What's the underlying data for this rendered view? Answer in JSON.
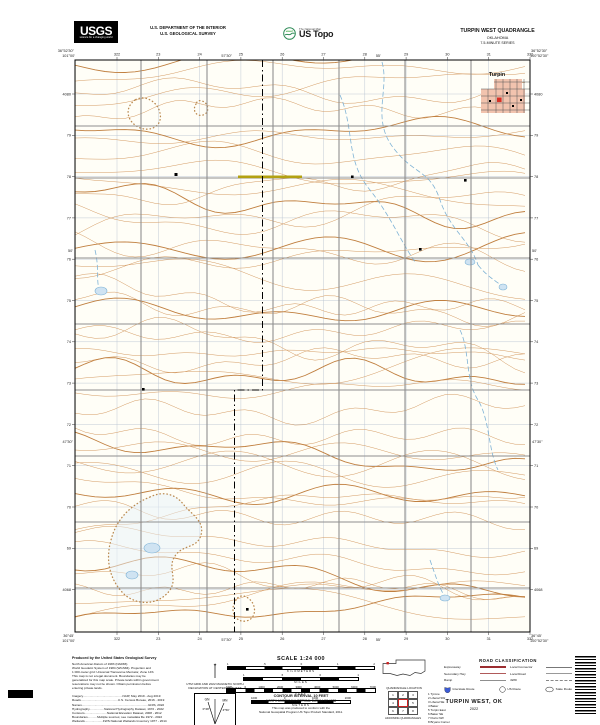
{
  "header": {
    "usgs_logo": "USGS",
    "usgs_tagline": "science for a changing world",
    "dept_line1": "U.S. DEPARTMENT OF THE INTERIOR",
    "dept_line2": "U.S. GEOLOGICAL SURVEY",
    "ustopo_super": "The National Map",
    "ustopo_brand": "US Topo",
    "quad_title": "TURPIN WEST QUADRANGLE",
    "state": "OKLAHOMA",
    "series": "7.5-MINUTE SERIES"
  },
  "map": {
    "town_label": "Turpin",
    "corners": {
      "top_left_lon": "101°00'",
      "top_left_lat": "36°52'30\"",
      "top_right_lon": "100°52'30\"",
      "top_right_lat": "36°52'30\"",
      "bottom_left_lon": "101°00'",
      "bottom_left_lat": "36°45'",
      "bottom_right_lon": "100°52'30\"",
      "bottom_right_lat": "36°45'"
    },
    "edge_ticks": {
      "top": [
        "57'30\"",
        "55'"
      ],
      "bottom": [
        "57'30\"",
        "55'"
      ],
      "left": [
        "50'",
        "47'30\""
      ],
      "right": [
        "50'",
        "47'30\""
      ]
    },
    "eastings": [
      "322",
      "23",
      "24",
      "25",
      "26",
      "27",
      "28",
      "29",
      "30",
      "31",
      "332"
    ],
    "northings": [
      "4080",
      "79",
      "78",
      "77",
      "76",
      "75",
      "74",
      "73",
      "72",
      "71",
      "70",
      "69",
      "4068"
    ]
  },
  "footer": {
    "credits": [
      "Produced by the United States Geological Survey",
      "North American Datum of 1983 (NAD83)",
      "World Geodetic System of 1984 (WGS84). Projection and",
      "1 000-meter grid: Universal Transverse Mercator, Zone 14S",
      "This map is not a legal document. Boundaries may be",
      "generalized for this map scale. Private lands within government",
      "reservations may not be shown. Obtain permission before",
      "entering private lands.",
      "",
      "Imagery..............................................NAIP, May 2019 - Aug 2019",
      "Roads...........................................U.S. Census Bureau, 2016 - 2019",
      "Names.............................................................................GNIS, 2022",
      "Hydrography.................National Hydrography Dataset, 1972 - 2022",
      "Contours..........................National Elevation Dataset, 2008 - 2012",
      "Boundaries...........Multiple sources; see metadata file 1972 - 2022",
      "Wetlands.....................FWS National Wetlands Inventory 1977 - 2014"
    ],
    "declination": {
      "caption1": "UTM GRID AND 2022 MAGNETIC NORTH",
      "caption2": "DECLINATION AT CENTER OF SHEET",
      "gn": "GN",
      "mn": "MN",
      "gn_value": "0°28'",
      "mn_value": "4°50'"
    },
    "scale": {
      "title": "SCALE 1:24 000",
      "bars": [
        {
          "label": "KILOMETERS",
          "ticks": [
            "1",
            ".5",
            "0",
            "1",
            "2"
          ],
          "width": 148
        },
        {
          "label": "MILES",
          "ticks": [
            "1",
            ".5",
            "0",
            "1"
          ],
          "width": 116
        },
        {
          "label": "FEET",
          "ticks": [
            "1000",
            "0",
            "1000",
            "2000",
            "3000",
            "4000",
            "5000",
            "6000",
            "7000"
          ],
          "width": 150
        },
        {
          "label": "METERS",
          "ticks": [
            "1000",
            "0",
            "1000",
            "2000"
          ],
          "width": 100
        }
      ]
    },
    "contour_note": "CONTOUR INTERVAL 10 FEET",
    "datum_note": "NORTH AMERICAN VERTICAL DATUM OF 1988",
    "standard_line1": "This map was produced to conform with the",
    "standard_line2": "National Geospatial Program US Topo Product Standard, 2011.",
    "quadrangle_location_label": "QUADRANGLE LOCATION",
    "adjoining_label": "ADJOINING QUADRANGLES",
    "adjoining_quads": [
      "Tyrone",
      "Liberal SW",
      "Liberal SE",
      "Baker",
      "Turpin East",
      "Baker SE",
      "Floris NW",
      "Bryans Corner"
    ],
    "road_classification": {
      "title": "ROAD CLASSIFICATION",
      "left": [
        {
          "label": "Expressway",
          "style": "expressway"
        },
        {
          "label": "Secondary Hwy",
          "style": "secondary"
        },
        {
          "label": "Ramp",
          "style": "ramp"
        }
      ],
      "right": [
        {
          "label": "Local Connector",
          "style": "connector"
        },
        {
          "label": "Local Road",
          "style": "local"
        },
        {
          "label": "4WD",
          "style": "fourwd"
        }
      ],
      "shields": [
        {
          "label": "Interstate Route",
          "type": "interstate"
        },
        {
          "label": "US Route",
          "type": "us"
        },
        {
          "label": "State Route",
          "type": "state"
        }
      ]
    },
    "map_name": "TURPIN WEST, OK",
    "year": "2022"
  },
  "colors": {
    "contour": "#d49a62",
    "contour_index": "#c07f3f",
    "water_line": "#7fb3d6",
    "water_fill": "#cfe3f2",
    "road_gray": "#8f8f8f",
    "utm_grid": "#a8b6c8",
    "town_fill": "#f2c3ae",
    "building_red": "#d83026",
    "highway_yellow": "#b3a111",
    "interstate_blue": "#3b5bd6"
  }
}
